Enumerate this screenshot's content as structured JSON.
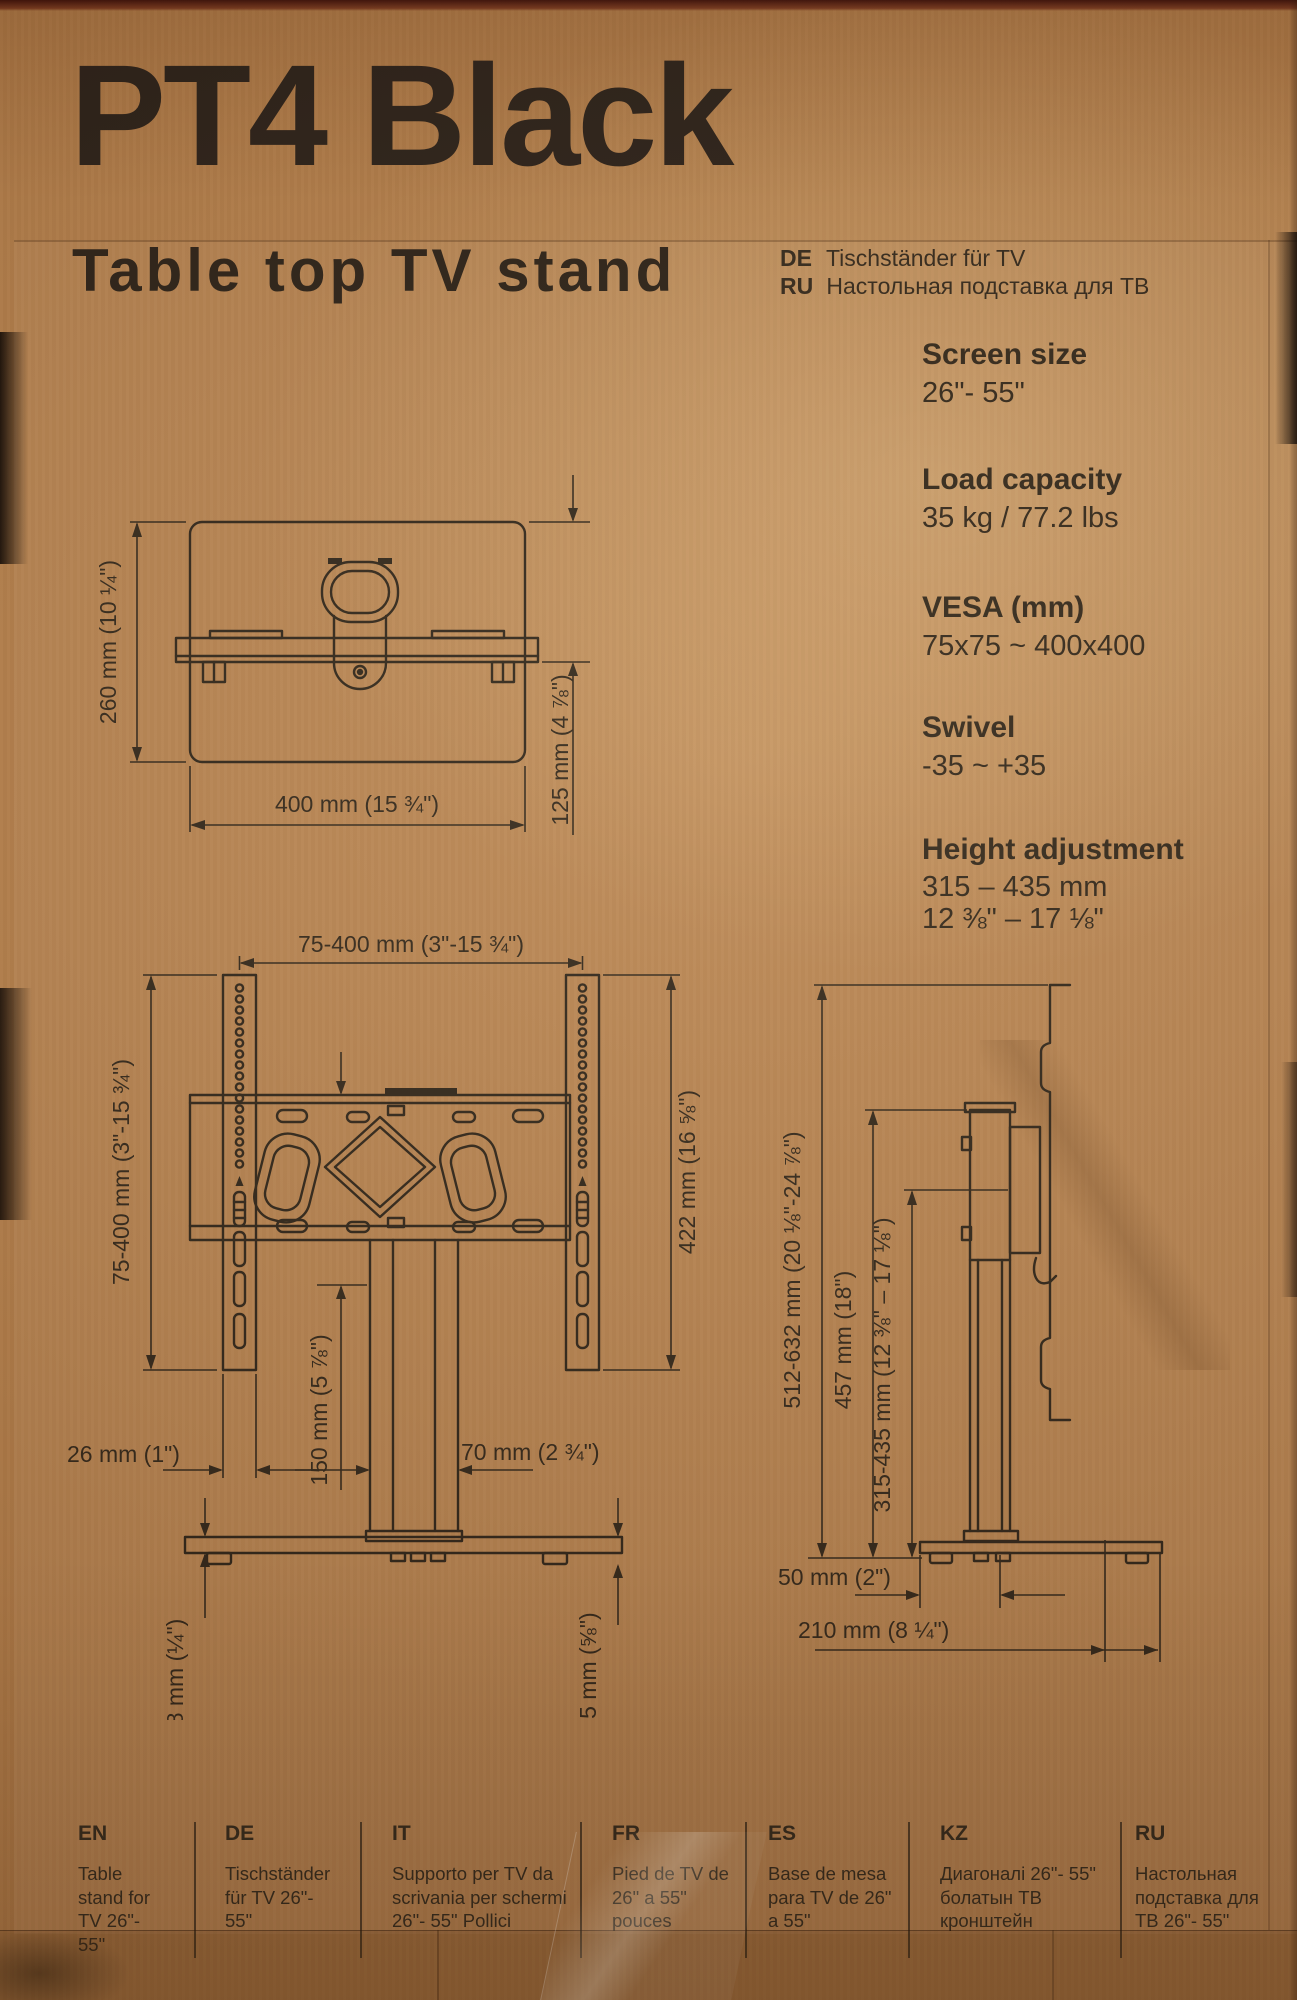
{
  "header": {
    "title": "PT4 Black",
    "subtitle": "Table top TV stand",
    "translations": [
      {
        "code": "DE",
        "text": "Tischständer für TV"
      },
      {
        "code": "RU",
        "text": "Настольная подставка для ТВ"
      }
    ]
  },
  "specs": [
    {
      "label": "Screen size",
      "value": "26\"- 55\""
    },
    {
      "label": "Load capacity",
      "value": "35 kg / 77.2 lbs"
    },
    {
      "label": "VESA (mm)",
      "value": "75x75 ~ 400x400"
    },
    {
      "label": "Swivel",
      "value": "-35 ~ +35"
    },
    {
      "label": "Height adjustment",
      "value": "315 – 435 mm",
      "value2": "12 ⅜\" – 17 ⅛\""
    }
  ],
  "diagrams": {
    "top_view": {
      "height": "260 mm (10 ¼\")",
      "width": "400 mm (15 ¾\")",
      "depth": "125 mm (4 ⅞\")"
    },
    "front_view": {
      "vesa_width": "75-400 mm (3\"-15 ¾\")",
      "vesa_height": "75-400 mm (3\"-15 ¾\")",
      "bracket_height": "422 mm (16 ⅝\")",
      "plate_offset": "150 mm (5 ⅞\")",
      "strip_width": "26 mm (1\")",
      "column_width": "70 mm (2 ¾\")",
      "base_thickness": "8 mm (¼\")",
      "base_total": "15 mm (⅝\")"
    },
    "side_view": {
      "overall_height": "512-632 mm (20 ⅛\"-24 ⅞\")",
      "column_height": "457 mm (18\")",
      "height_range": "315-435 mm (12 ⅜\" – 17 ⅛\")",
      "base_front": "50 mm (2\")",
      "base_depth": "210 mm (8 ¼\")"
    }
  },
  "languages": [
    {
      "code": "EN",
      "text": "Table stand for TV 26\"- 55\""
    },
    {
      "code": "DE",
      "text": "Tischständer für TV 26\"- 55\""
    },
    {
      "code": "IT",
      "text": "Supporto per TV da scrivania per schermi 26\"- 55\" Pollici"
    },
    {
      "code": "FR",
      "text": "Pied de TV de 26\" a 55\" pouces"
    },
    {
      "code": "ES",
      "text": "Base de mesa para TV de 26\" a 55\""
    },
    {
      "code": "KZ",
      "text": "Диагоналі 26\"- 55\" болатын ТВ кронштейн"
    },
    {
      "code": "RU",
      "text": "Настольная подставка для ТВ 26\"- 55\""
    }
  ],
  "colors": {
    "cardboard": "#b9834e",
    "ink": "#2f261b"
  }
}
